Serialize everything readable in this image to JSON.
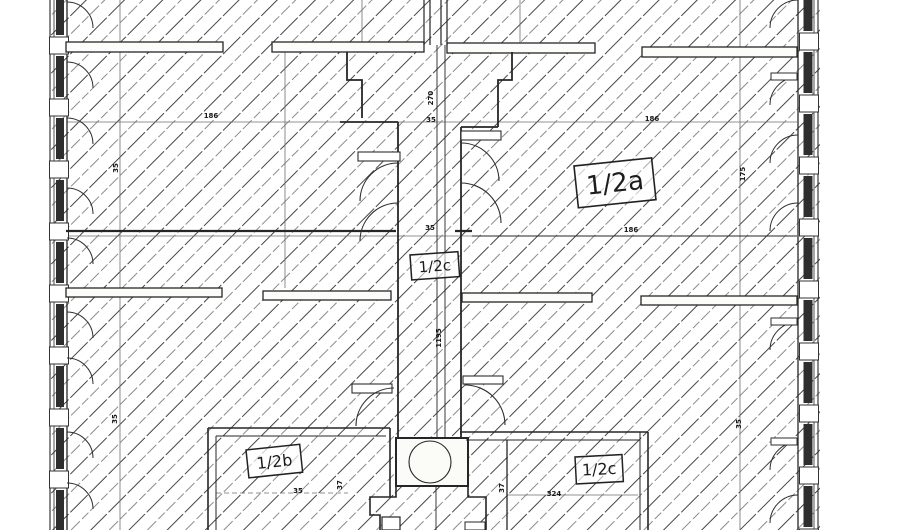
{
  "labels": {
    "room_a": "1/2a",
    "hall": "1/2c",
    "room_b": "1/2b",
    "room_c": "1/2c"
  },
  "dimensions": [
    {
      "text": "186"
    },
    {
      "text": "35"
    },
    {
      "text": "270"
    },
    {
      "text": "35"
    },
    {
      "text": "186"
    },
    {
      "text": "175"
    },
    {
      "text": "35"
    },
    {
      "text": "186"
    },
    {
      "text": "1195"
    },
    {
      "text": "35"
    },
    {
      "text": "35"
    },
    {
      "text": "35"
    },
    {
      "text": "37"
    },
    {
      "text": "37"
    },
    {
      "text": "324"
    }
  ],
  "colors": {
    "paper": "#ffffff",
    "line": "#262626",
    "hatch_dark": "#454545",
    "hatch_light": "#8b8b8b"
  }
}
